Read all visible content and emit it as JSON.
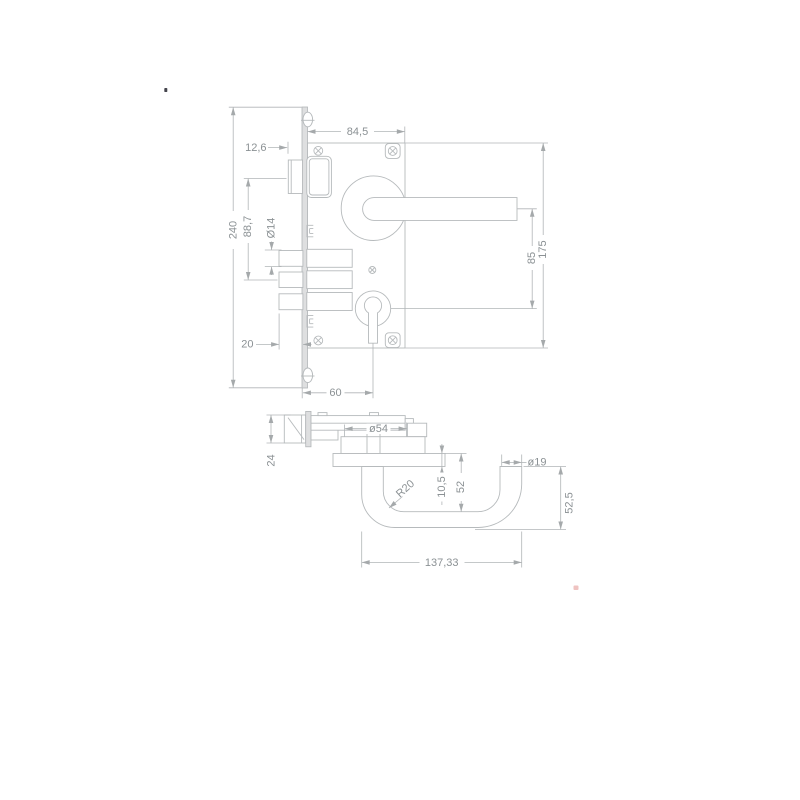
{
  "drawing": {
    "lock_view": {
      "case_width": "84,5",
      "latch_protrusion": "12,6",
      "latch_to_deadbolt": "88,7",
      "deadbolt_diameter": "Ø14",
      "faceplate_height": "240",
      "deadbolt_throw": "20",
      "backset": "60",
      "handle_to_cylinder": "85",
      "case_height": "175"
    },
    "handle_view": {
      "latch_height": "24",
      "rose_diameter": "ø54",
      "lever_diameter": "ø19",
      "corner_radius": "R20",
      "rose_thickness": "10,5",
      "grip_clearance": "52",
      "end_height": "52,5",
      "handle_length": "137,33"
    }
  }
}
